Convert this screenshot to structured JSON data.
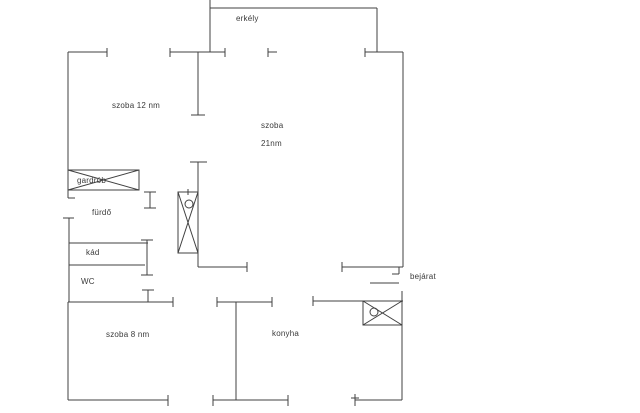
{
  "floorplan": {
    "canvas": {
      "width": 640,
      "height": 413,
      "background": "#ffffff",
      "line_color": "#404040"
    },
    "labels": {
      "erkely": {
        "text": "erkély"
      },
      "szoba12": {
        "text": "szoba 12 nm"
      },
      "szoba21_line1": {
        "text": "szoba"
      },
      "szoba21_line2": {
        "text": "21nm"
      },
      "gardrob": {
        "text": "gardrób"
      },
      "furdo": {
        "text": "fürdő"
      },
      "kad": {
        "text": "kád"
      },
      "wc": {
        "text": "WC"
      },
      "szoba8": {
        "text": "szoba 8 nm"
      },
      "konyha": {
        "text": "konyha"
      },
      "bejarat": {
        "text": "bejárat"
      }
    },
    "walls": [
      [
        210,
        0,
        210,
        52
      ],
      [
        210,
        8,
        377,
        8
      ],
      [
        377,
        8,
        377,
        52
      ],
      [
        68,
        52,
        107,
        52
      ],
      [
        170,
        52,
        225,
        52
      ],
      [
        268,
        52,
        277,
        52
      ],
      [
        365,
        52,
        403,
        52
      ],
      [
        403,
        52,
        403,
        267
      ],
      [
        342,
        267,
        403,
        267
      ],
      [
        313,
        301,
        403,
        301
      ],
      [
        402,
        325,
        402,
        400
      ],
      [
        355,
        400,
        402,
        400
      ],
      [
        68,
        52,
        68,
        190
      ],
      [
        68,
        190,
        68,
        198
      ],
      [
        68,
        198,
        75,
        198
      ],
      [
        150,
        192,
        150,
        208
      ],
      [
        69,
        218,
        69,
        302
      ],
      [
        69,
        243,
        148,
        243
      ],
      [
        69,
        265,
        145,
        265
      ],
      [
        147,
        240,
        147,
        275
      ],
      [
        148,
        290,
        148,
        302
      ],
      [
        68,
        302,
        173,
        302
      ],
      [
        68,
        302,
        68,
        400
      ],
      [
        68,
        400,
        168,
        400
      ],
      [
        198,
        52,
        198,
        115
      ],
      [
        198,
        162,
        198,
        267
      ],
      [
        198,
        267,
        247,
        267
      ],
      [
        217,
        302,
        272,
        302
      ],
      [
        236,
        302,
        236,
        400
      ],
      [
        213,
        400,
        288,
        400
      ]
    ],
    "ticks": [
      [
        107,
        48,
        107,
        57
      ],
      [
        170,
        48,
        170,
        57
      ],
      [
        225,
        48,
        225,
        57
      ],
      [
        268,
        48,
        268,
        57
      ],
      [
        365,
        48,
        365,
        57
      ],
      [
        342,
        262,
        342,
        272
      ],
      [
        399,
        267,
        399,
        274
      ],
      [
        392,
        274,
        399,
        274
      ],
      [
        313,
        296,
        313,
        306
      ],
      [
        402,
        291,
        402,
        301
      ],
      [
        355,
        394,
        355,
        406
      ],
      [
        351,
        398,
        359,
        398
      ],
      [
        144,
        192,
        156,
        192
      ],
      [
        144,
        208,
        156,
        208
      ],
      [
        63,
        218,
        74,
        218
      ],
      [
        141,
        240,
        153,
        240
      ],
      [
        141,
        275,
        153,
        275
      ],
      [
        142,
        290,
        154,
        290
      ],
      [
        173,
        297,
        173,
        307
      ],
      [
        168,
        395,
        168,
        406
      ],
      [
        191,
        115,
        205,
        115
      ],
      [
        190,
        162,
        207,
        162
      ],
      [
        188,
        189,
        188,
        195
      ],
      [
        247,
        262,
        247,
        272
      ],
      [
        217,
        297,
        217,
        307
      ],
      [
        272,
        297,
        272,
        307
      ],
      [
        213,
        395,
        213,
        406
      ],
      [
        288,
        395,
        288,
        406
      ]
    ],
    "door_lines": [
      [
        370,
        283,
        399,
        283
      ]
    ],
    "fixtures": [
      {
        "name": "gardrob-closet",
        "x": 68,
        "y": 170,
        "w": 71,
        "h": 20,
        "circle": null
      },
      {
        "name": "bathroom-cabinet",
        "x": 178,
        "y": 192,
        "w": 20,
        "h": 61,
        "circle": [
          189,
          204,
          4
        ]
      },
      {
        "name": "entry-closet",
        "x": 363,
        "y": 301,
        "w": 39,
        "h": 24,
        "circle": [
          374,
          312,
          4
        ]
      }
    ]
  }
}
